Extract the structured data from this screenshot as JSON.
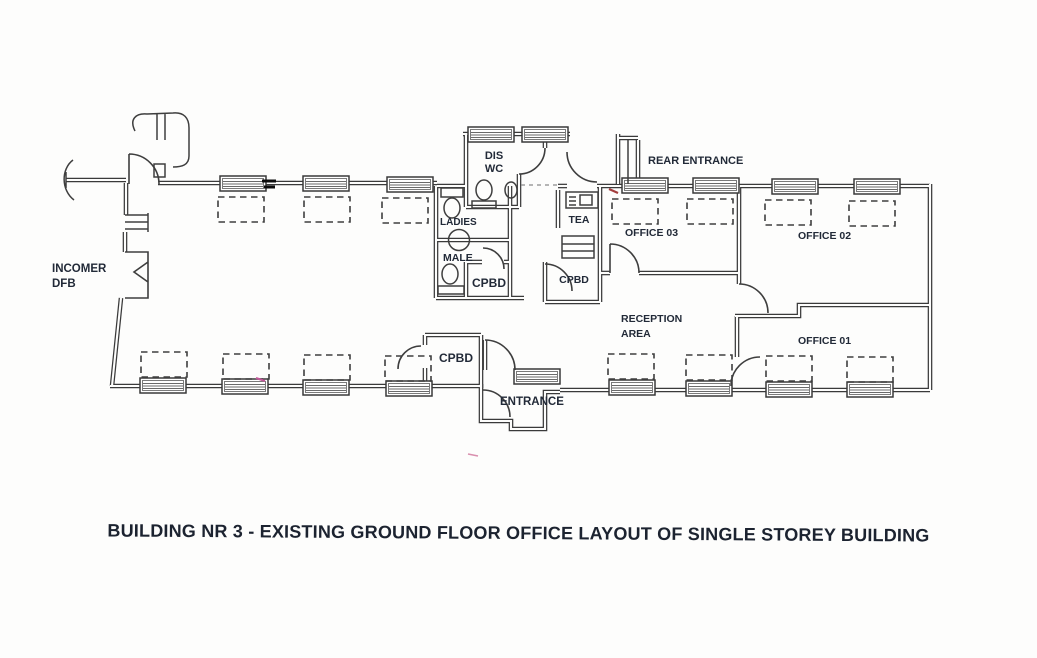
{
  "title": "BUILDING NR 3 - EXISTING GROUND FLOOR OFFICE LAYOUT OF SINGLE STOREY BUILDING",
  "plan": {
    "labels": {
      "incomer_line1": "INCOMER",
      "incomer_line2": "DFB",
      "dis_wc_line1": "DIS",
      "dis_wc_line2": "WC",
      "ladies": "LADIES",
      "male": "MALE",
      "cpbd_wc_block": "CPBD",
      "tea": "TEA",
      "cpbd_corridor": "CPBD",
      "cpbd_entrance": "CPBD",
      "rear_entrance": "REAR ENTRANCE",
      "office_03": "OFFICE 03",
      "office_02": "OFFICE 02",
      "office_01": "OFFICE 01",
      "reception_line1": "RECEPTION",
      "reception_line2": "AREA",
      "entrance": "ENTRANCE"
    },
    "colors": {
      "wall": "#3a3a3a",
      "label_text": "#222a38",
      "title_text": "#1c2330",
      "paper": "#fdfdfc",
      "scan_mark_black": "#0c0c0c",
      "scan_mark_red": "#a33d3d",
      "scan_mark_pink": "#c2589a"
    }
  }
}
